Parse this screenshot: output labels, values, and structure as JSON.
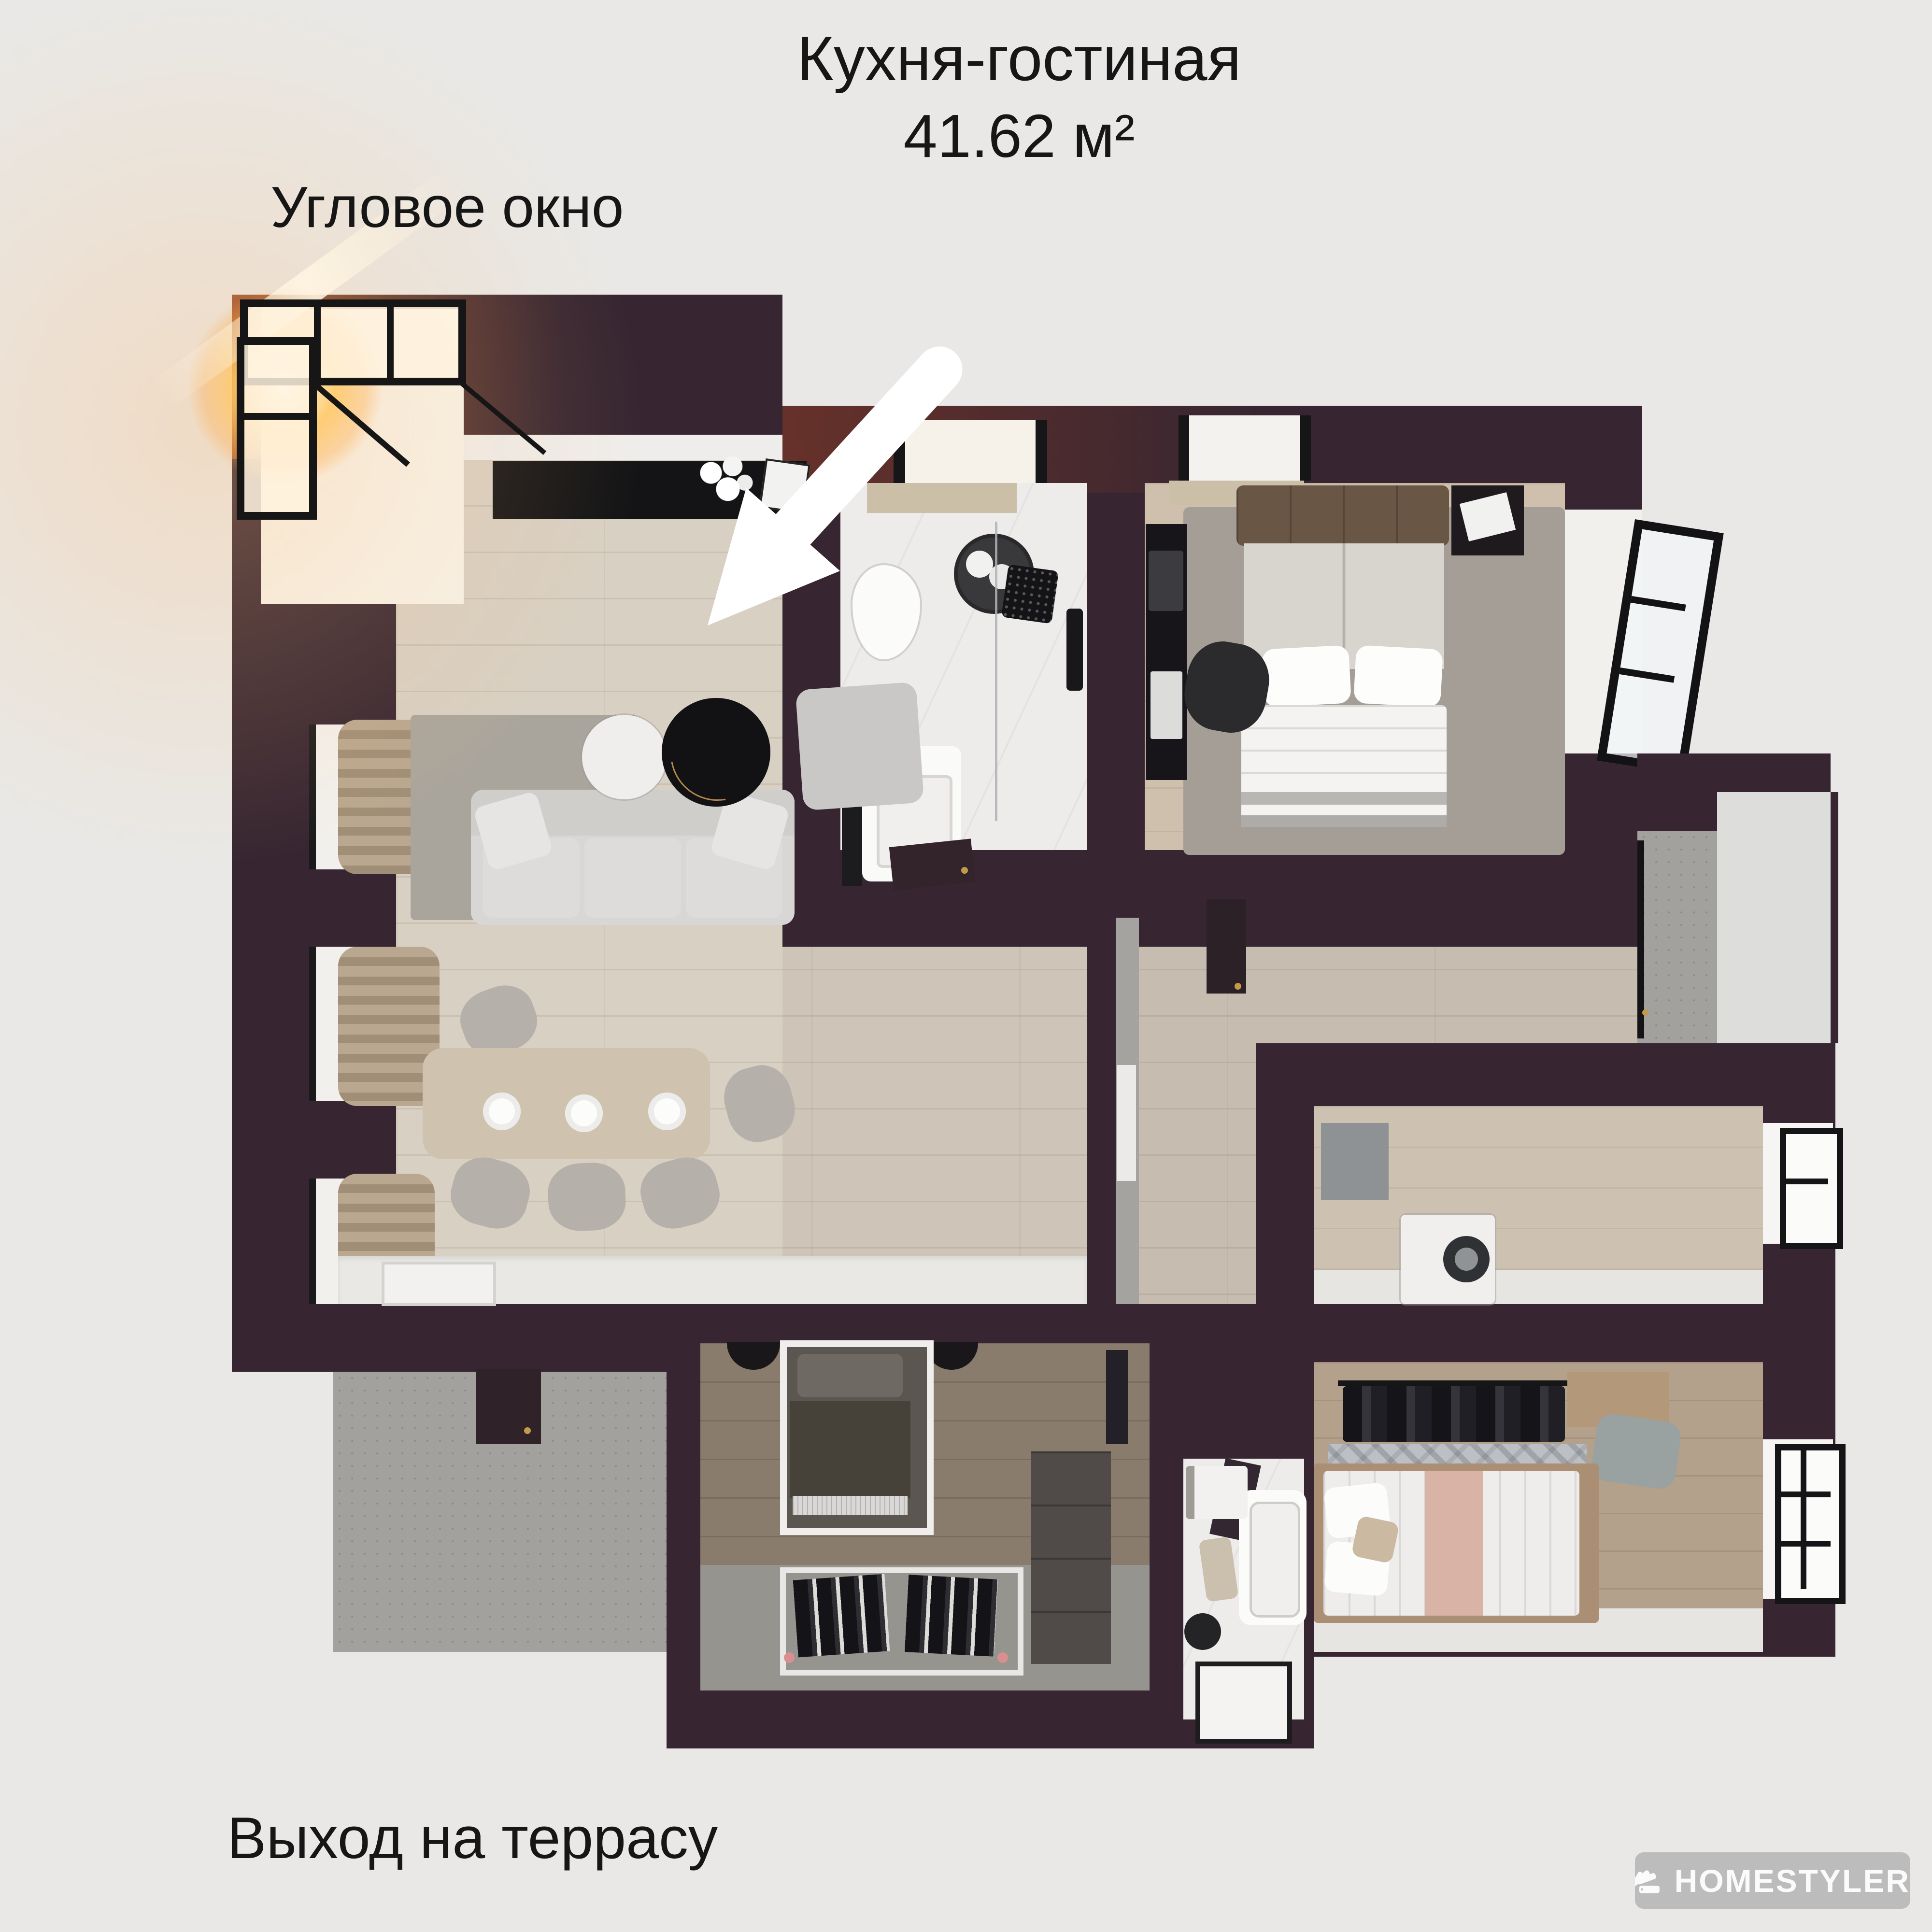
{
  "title": {
    "line1": "Кухня-гостиная",
    "line2": "41.62 м²"
  },
  "annotations": {
    "corner_window": "Угловое окно",
    "terrace_exit": "Выход на террасу"
  },
  "watermark": {
    "brand": "HOMESTYLER"
  },
  "colors": {
    "background": "#e9e8e6",
    "text": "#161616",
    "wall": "#372631",
    "wall_lit": "#9c4f28",
    "wood_floor": "#d8d0c3",
    "dark_wood": "#8a7c6d",
    "bedroom_wood": "#cfc0ae",
    "concrete": "#a2a19d",
    "marble": "#edecea",
    "sun": "#ffb85c",
    "arrow": "#ffffff",
    "watermark_bg": "#b8b8b8"
  }
}
